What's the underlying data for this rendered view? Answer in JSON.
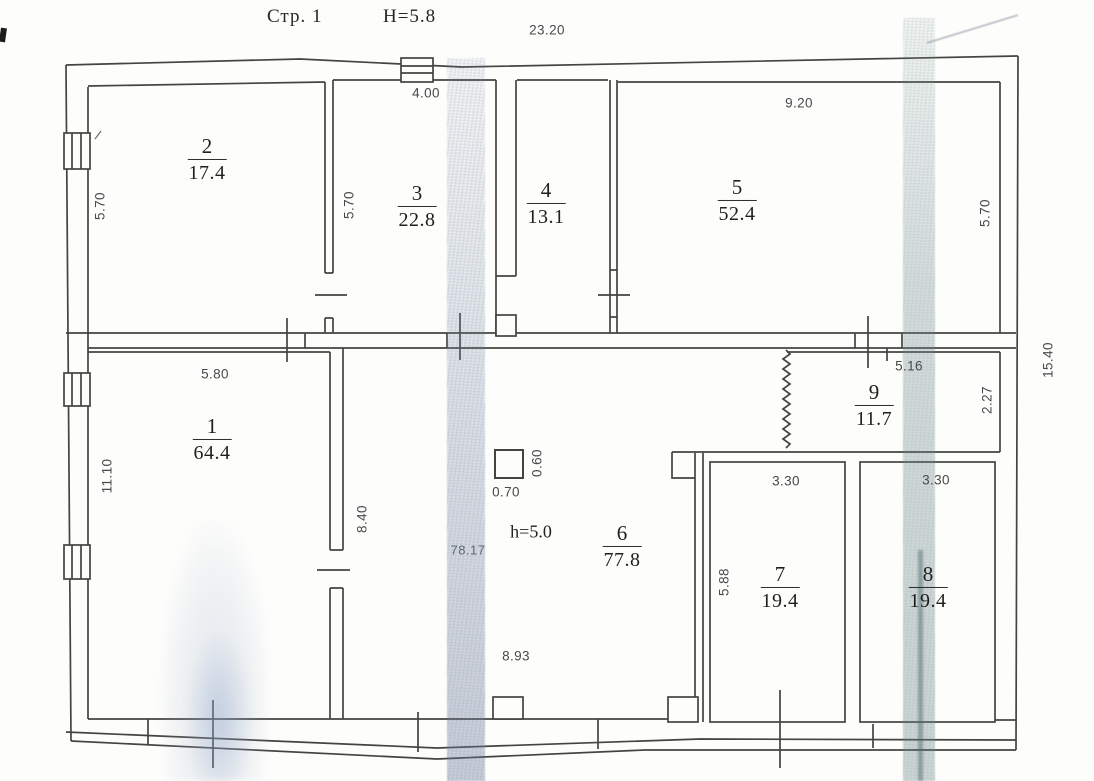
{
  "header": {
    "page_label": "Стр. 1",
    "height_label": "Н=5.8"
  },
  "rooms": [
    {
      "number": "2",
      "area": "17.4",
      "cx": 207,
      "cy": 160
    },
    {
      "number": "3",
      "area": "22.8",
      "cx": 417,
      "cy": 207
    },
    {
      "number": "4",
      "area": "13.1",
      "cx": 546,
      "cy": 204
    },
    {
      "number": "5",
      "area": "52.4",
      "cx": 737,
      "cy": 201
    },
    {
      "number": "1",
      "area": "64.4",
      "cx": 212,
      "cy": 440
    },
    {
      "number": "6",
      "area": "77.8",
      "cx": 622,
      "cy": 547
    },
    {
      "number": "9",
      "area": "11.7",
      "cx": 874,
      "cy": 406
    },
    {
      "number": "7",
      "area": "19.4",
      "cx": 780,
      "cy": 588
    },
    {
      "number": "8",
      "area": "19.4",
      "cx": 928,
      "cy": 588
    }
  ],
  "dimensions": [
    {
      "text": "23.20",
      "x": 547,
      "y": 30,
      "rot": 0
    },
    {
      "text": "4.00",
      "x": 426,
      "y": 93,
      "rot": 0
    },
    {
      "text": "9.20",
      "x": 799,
      "y": 103,
      "rot": 0
    },
    {
      "text": "5.70",
      "x": 100,
      "y": 206,
      "rot": -90
    },
    {
      "text": "5.70",
      "x": 349,
      "y": 205,
      "rot": -90
    },
    {
      "text": "5.70",
      "x": 985,
      "y": 213,
      "rot": -90
    },
    {
      "text": "5.80",
      "x": 215,
      "y": 374,
      "rot": 0
    },
    {
      "text": "11.10",
      "x": 107,
      "y": 476,
      "rot": -90
    },
    {
      "text": "8.40",
      "x": 362,
      "y": 519,
      "rot": -90
    },
    {
      "text": "0.60",
      "x": 537,
      "y": 463,
      "rot": -90
    },
    {
      "text": "0.70",
      "x": 506,
      "y": 492,
      "rot": 0
    },
    {
      "text": "8.93",
      "x": 516,
      "y": 656,
      "rot": 0
    },
    {
      "text": "5.16",
      "x": 909,
      "y": 366,
      "rot": 0
    },
    {
      "text": "2.27",
      "x": 987,
      "y": 400,
      "rot": -90
    },
    {
      "text": "3.30",
      "x": 786,
      "y": 481,
      "rot": 0
    },
    {
      "text": "3.30",
      "x": 936,
      "y": 480,
      "rot": 0
    },
    {
      "text": "5.88",
      "x": 724,
      "y": 582,
      "rot": -90
    },
    {
      "text": "15.40",
      "x": 1048,
      "y": 360,
      "rot": -90
    }
  ],
  "annotations": [
    {
      "text": "h=5.0",
      "x": 531,
      "y": 532,
      "style": "serif"
    },
    {
      "text": "78.17",
      "x": 468,
      "y": 550,
      "style": "faint"
    }
  ]
}
